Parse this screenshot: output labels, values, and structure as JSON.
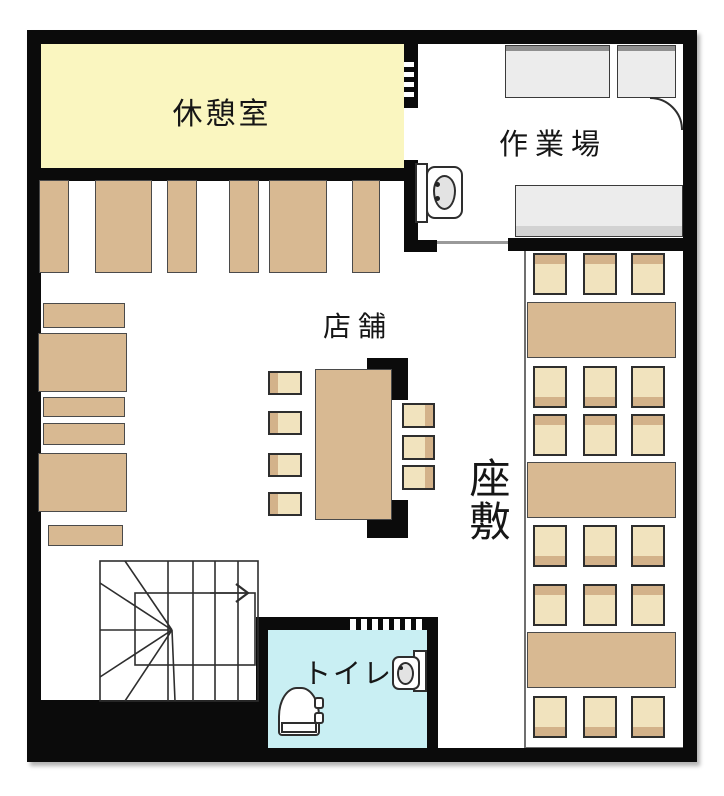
{
  "floorplan": {
    "rooms": {
      "breakroom": {
        "label": "休憩室"
      },
      "workspace": {
        "label": "作業場"
      },
      "shop": {
        "label": "店舗"
      },
      "tatami": {
        "label": "座敷"
      },
      "toilet": {
        "label": "トイレ"
      }
    },
    "colors": {
      "wall": "#0b0b0b",
      "breakroom_fill": "#faf6c0",
      "toilet_fill": "#c9eff3",
      "furniture_tan": "#d8b992",
      "chair_light": "#f1e3be",
      "chair_accent": "#d3b28a",
      "counter_gray": "#ececec",
      "background": "#ffffff"
    },
    "icons": {
      "stairs-icon": "grid-of-treads-with-winders",
      "stairs-up-arrow-icon": "right-arrow",
      "door-swing-icon": "quarter-arc",
      "kitchen-sink-icon": "rounded-square-basin",
      "toilet-icon": "dome-bowl",
      "toilet-sink-icon": "rounded-square-basin"
    },
    "furniture_counts": {
      "breakroom_lockers": 6,
      "left_wall_shelves": 6,
      "shop_chairs": 7,
      "tatami_tables": 3,
      "tatami_chairs": 18,
      "workspace_counters": 3
    }
  }
}
